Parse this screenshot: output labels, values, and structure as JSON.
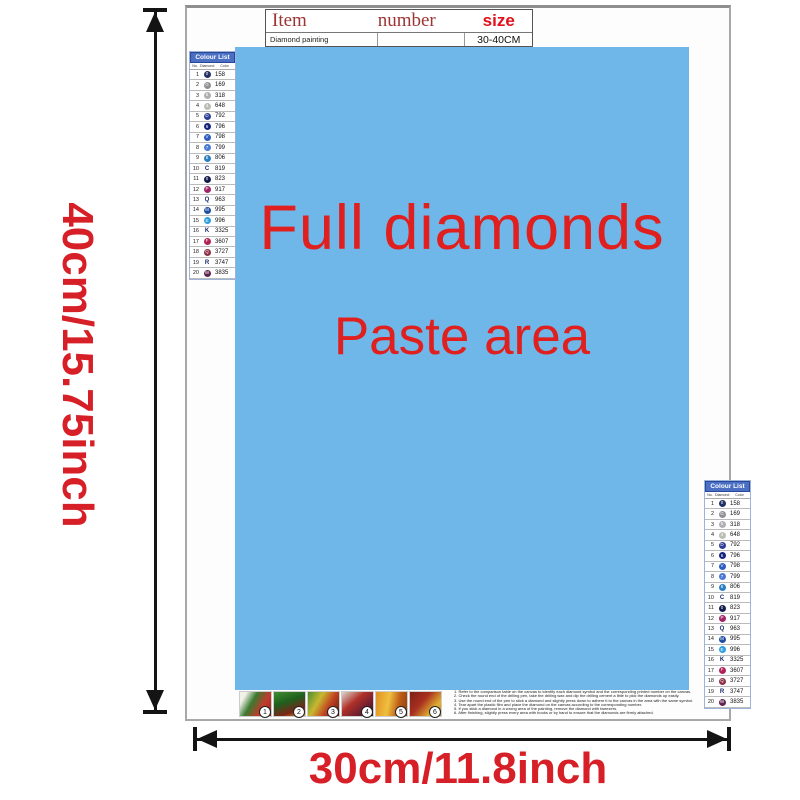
{
  "colors": {
    "paste_blue": "#70b7e9",
    "label_red": "#d71f27",
    "paste_text_red": "#e0201f",
    "header_blue": "#4a6fc3"
  },
  "dimensions": {
    "height_label": "40cm/15.75inch",
    "width_label": "30cm/11.8inch"
  },
  "item_table": {
    "col1": "Item",
    "col2": "number",
    "col3": "size",
    "row_item": "Diamond painting",
    "row_number": "",
    "row_size": "30-40CM"
  },
  "paste_area": {
    "line1": "Full diamonds",
    "line2": "Paste area"
  },
  "color_list": {
    "title": "Colour List",
    "columns": [
      "No.",
      "Diamond",
      "Color"
    ],
    "rows": [
      {
        "no": "1",
        "code": "158",
        "circle": true,
        "fill": "#232f66",
        "symbol": "0"
      },
      {
        "no": "2",
        "code": "169",
        "circle": true,
        "fill": "#8f9094",
        "symbol": "G"
      },
      {
        "no": "3",
        "code": "318",
        "circle": true,
        "fill": "#aeb0b3",
        "symbol": "5"
      },
      {
        "no": "4",
        "code": "648",
        "circle": true,
        "fill": "#babdb2",
        "symbol": "4"
      },
      {
        "no": "5",
        "code": "792",
        "circle": true,
        "fill": "#2e3f94",
        "symbol": "D"
      },
      {
        "no": "6",
        "code": "796",
        "circle": true,
        "fill": "#16257c",
        "symbol": "6"
      },
      {
        "no": "7",
        "code": "798",
        "circle": true,
        "fill": "#2d5cbe",
        "symbol": "V"
      },
      {
        "no": "8",
        "code": "799",
        "circle": true,
        "fill": "#4a79d4",
        "symbol": "7"
      },
      {
        "no": "9",
        "code": "806",
        "circle": true,
        "fill": "#2a7fc2",
        "symbol": "8"
      },
      {
        "no": "10",
        "code": "819",
        "circle": false,
        "fill": "",
        "symbol": "C"
      },
      {
        "no": "11",
        "code": "823",
        "circle": true,
        "fill": "#111c4d",
        "symbol": "0"
      },
      {
        "no": "12",
        "code": "917",
        "circle": true,
        "fill": "#a02468",
        "symbol": "P"
      },
      {
        "no": "13",
        "code": "963",
        "circle": false,
        "fill": "",
        "symbol": "Q"
      },
      {
        "no": "14",
        "code": "995",
        "circle": true,
        "fill": "#1d4ea0",
        "symbol": "M"
      },
      {
        "no": "15",
        "code": "996",
        "circle": true,
        "fill": "#2f9ede",
        "symbol": "E"
      },
      {
        "no": "16",
        "code": "3325",
        "circle": false,
        "fill": "",
        "symbol": "K"
      },
      {
        "no": "17",
        "code": "3607",
        "circle": true,
        "fill": "#b02358",
        "symbol": "F"
      },
      {
        "no": "18",
        "code": "3727",
        "circle": true,
        "fill": "#8c2f46",
        "symbol": "Q"
      },
      {
        "no": "19",
        "code": "3747",
        "circle": false,
        "fill": "",
        "symbol": "R"
      },
      {
        "no": "20",
        "code": "3835",
        "circle": true,
        "fill": "#5f2550",
        "symbol": "W"
      }
    ]
  },
  "thumbnails": [
    {
      "label": "1",
      "gradient": "linear-gradient(120deg,#f2f2ea 15%,#3a7a30 40%,#c5392b 70%,#8a2a20 100%)"
    },
    {
      "label": "2",
      "gradient": "linear-gradient(160deg,#3f8f2f 0%,#1f5f1f 40%,#7a2418 75%,#e0a020 100%)"
    },
    {
      "label": "3",
      "gradient": "linear-gradient(120deg,#4a8f2f 0%,#c8b830 35%,#c04020 65%,#5f1f10 100%)"
    },
    {
      "label": "4",
      "gradient": "linear-gradient(140deg,#d8d8d0 0%,#b03028 40%,#6f1f2f 70%,#3f0f1f 100%)"
    },
    {
      "label": "5",
      "gradient": "linear-gradient(100deg,#e08f20 0%,#f0c040 40%,#c06018 70%,#8f3f10 100%)"
    },
    {
      "label": "6",
      "gradient": "linear-gradient(130deg,#7f1f18 0%,#a83020 40%,#e0b030 75%,#c07f20 100%)"
    }
  ],
  "instructions": {
    "lines": [
      "1. Refer to the comparison table on the canvas to identify each diamond symbol and the corresponding printed number on the canvas.",
      "2. Check the round end of the drilling pen, take the drilling wax and dip the drilling cement a little to pick the diamonds up easily.",
      "3. Use the round end of the pen to stick a diamond and slightly press down to adhere it to the canvas in the area with the same symbol.",
      "4. Tear apart the plastic film and place the diamond on the canvas according to the corresponding number.",
      "5. If you stick a diamond in a wrong area of the painting, remove the diamond with tweezers.",
      "6. After finishing, slightly press every area with books or by hand to ensure that the diamonds are firmly attached."
    ]
  }
}
